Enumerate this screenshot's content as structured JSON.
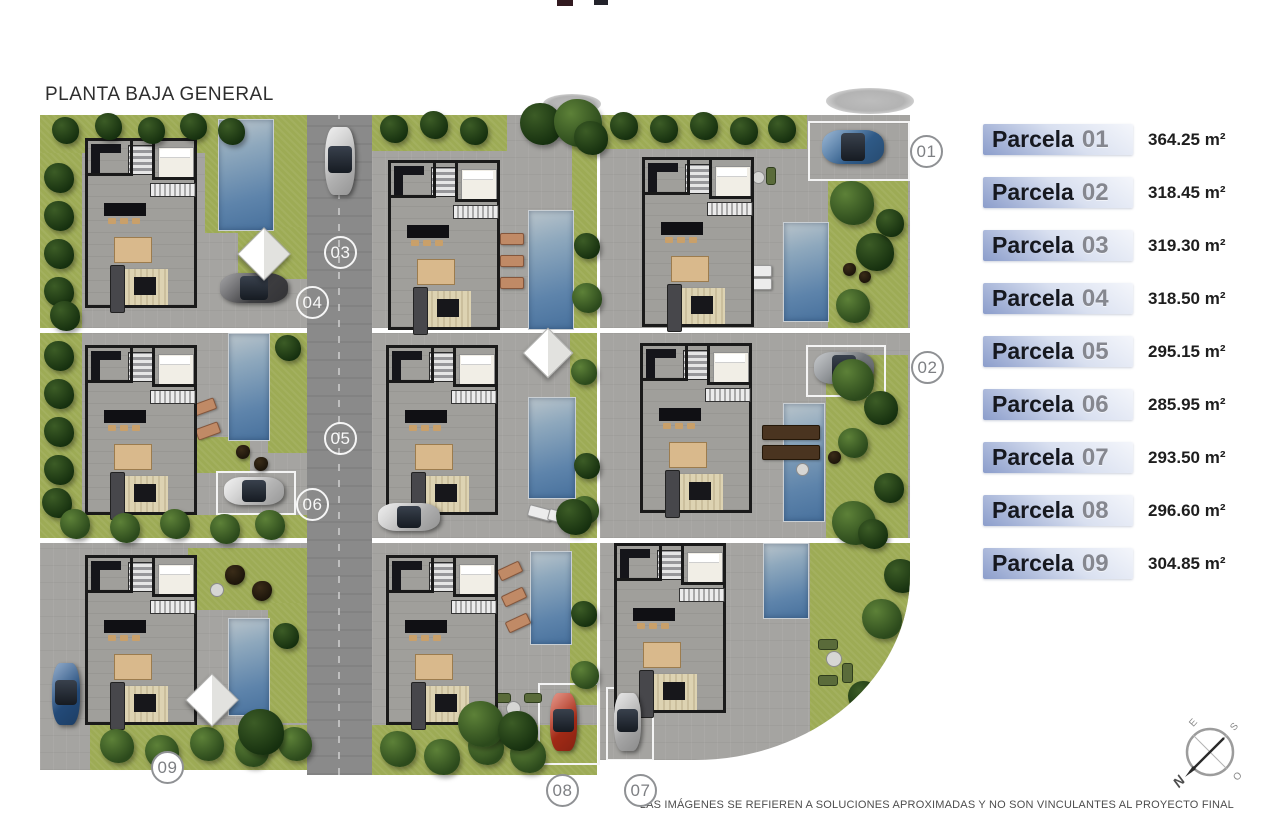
{
  "title": "PLANTA BAJA GENERAL",
  "legend": {
    "items": [
      {
        "name": "Parcela",
        "number": "01",
        "area": "364.25 m²"
      },
      {
        "name": "Parcela",
        "number": "02",
        "area": "318.45 m²"
      },
      {
        "name": "Parcela",
        "number": "03",
        "area": "319.30 m²"
      },
      {
        "name": "Parcela",
        "number": "04",
        "area": "318.50 m²"
      },
      {
        "name": "Parcela",
        "number": "05",
        "area": "295.15 m²"
      },
      {
        "name": "Parcela",
        "number": "06",
        "area": "285.95 m²"
      },
      {
        "name": "Parcela",
        "number": "07",
        "area": "293.50 m²"
      },
      {
        "name": "Parcela",
        "number": "08",
        "area": "296.60 m²"
      },
      {
        "name": "Parcela",
        "number": "09",
        "area": "304.85 m²"
      }
    ]
  },
  "plan": {
    "markers": [
      {
        "label": "01",
        "variant": "edge"
      },
      {
        "label": "02",
        "variant": "edge"
      },
      {
        "label": "03",
        "variant": "road"
      },
      {
        "label": "04",
        "variant": "road"
      },
      {
        "label": "05",
        "variant": "road"
      },
      {
        "label": "06",
        "variant": "road"
      },
      {
        "label": "07",
        "variant": "edge"
      },
      {
        "label": "08",
        "variant": "edge"
      },
      {
        "label": "09",
        "variant": "edge"
      }
    ]
  },
  "compass": {
    "n": "N",
    "s": "S",
    "e": "E",
    "o": "O"
  },
  "footer": {
    "disclaimer": "LAS IMÁGENES SE REFIEREN A SOLUCIONES APROXIMADAS Y NO SON VINCULANTES AL PROYECTO FINAL"
  },
  "colors": {
    "legend_bar_light": "#f4f6fb",
    "legend_bar_dark": "#8b9dcb",
    "pool": "#5e84ab",
    "lawn": "#9dab55",
    "paving": "#a5a4a1",
    "road": "#8a8a8a",
    "tree": "#2c4a1c",
    "car_red": "#c9341b",
    "car_blue": "#3a70a8"
  }
}
